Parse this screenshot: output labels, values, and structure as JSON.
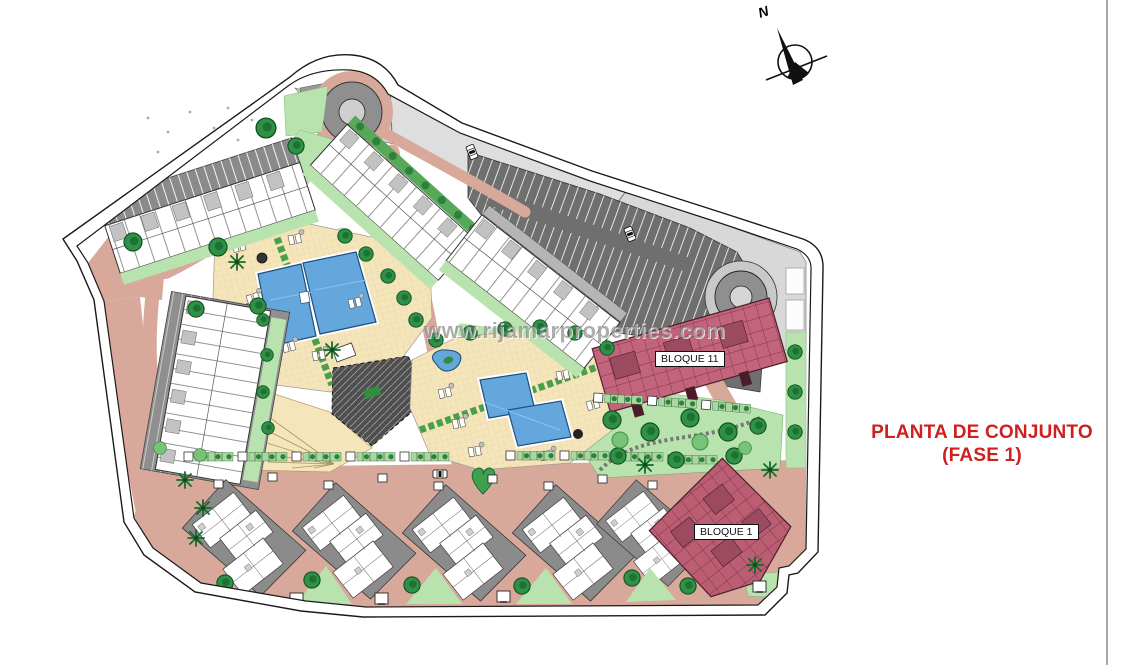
{
  "sheet": {
    "background": "#ffffff",
    "divider_color": "#a8a8a8",
    "title_line1": "PLANTA DE CONJUNTO",
    "title_line2": "(FASE 1)",
    "title_color": "#cf1f1f"
  },
  "plan": {
    "north_label": "N",
    "watermark": "www.rijamarproperties.com",
    "block_labels": [
      {
        "id": "bloque-11",
        "label": "BLOQUE 11"
      },
      {
        "id": "bloque-1",
        "label": "BLOQUE 1"
      }
    ],
    "colors": {
      "road_pink": "#d8a99b",
      "green_light": "#b9e3ae",
      "green_dark": "#2f9148",
      "sand": "#f4e5bb",
      "pool_blue": "#63a7dd",
      "parking_dark": "#6f6f6f",
      "street_gray": "#d8d8d8",
      "highlight_block_red": "#c2647b",
      "building_white": "#ffffff"
    }
  }
}
